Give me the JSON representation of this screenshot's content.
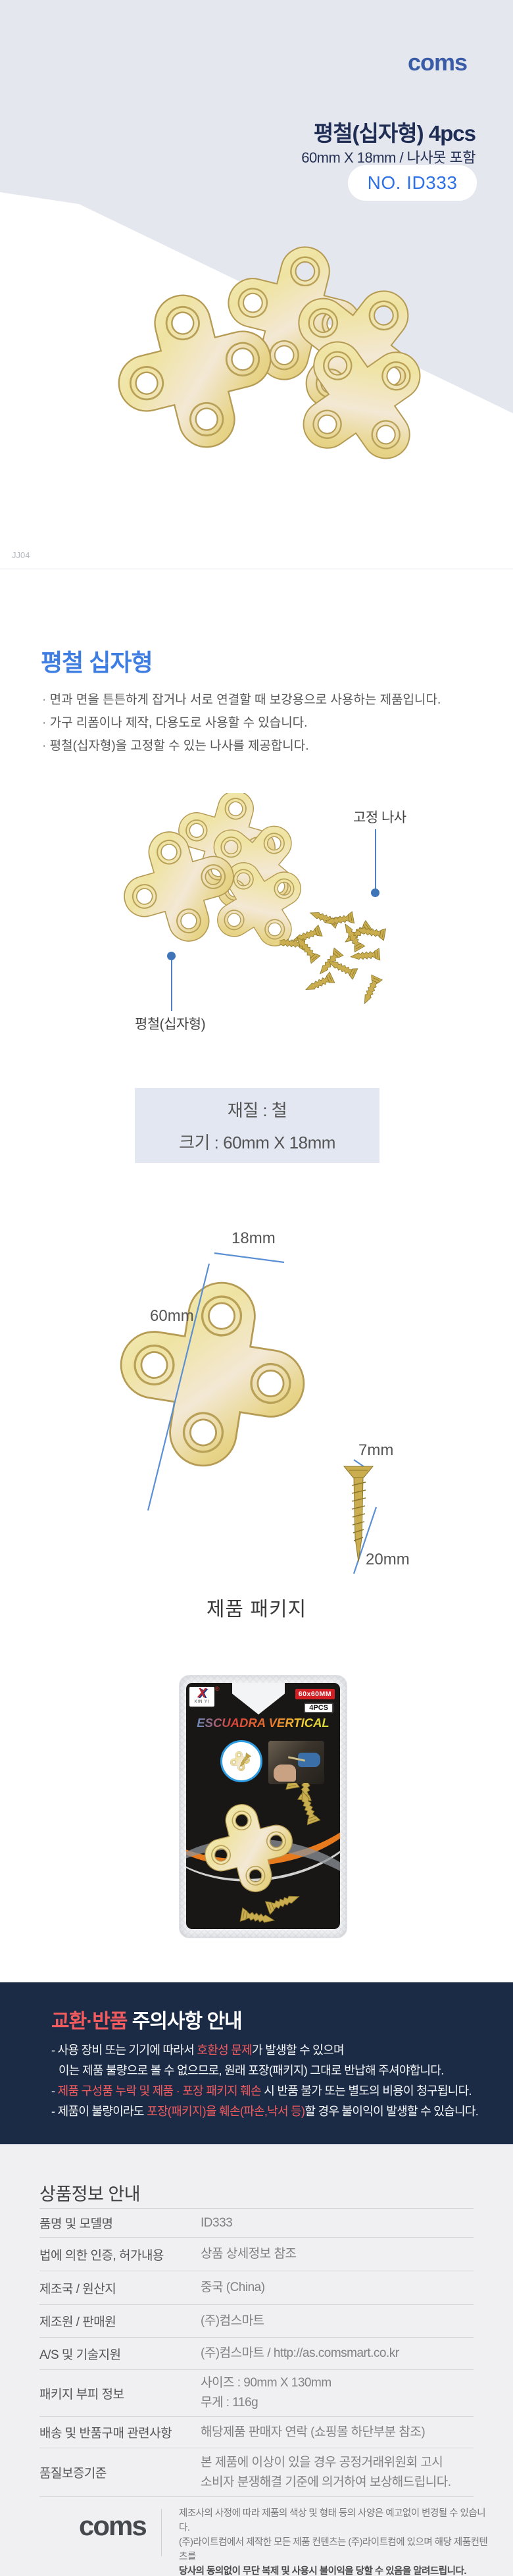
{
  "header": {
    "logo": "coms",
    "title": "평철(십자형) 4pcs",
    "subtitle": "60mm X 18mm / 나사못 포함",
    "badge": "NO. ID333",
    "watermark": "JJ04"
  },
  "intro": {
    "heading": "평철 십자형",
    "bullets": [
      "면과 면을 튼튼하게 잡거나 서로 연결할 때 보강용으로 사용하는 제품입니다.",
      "가구 리폼이나 제작, 다용도로 사용할 수 있습니다.",
      "평철(십자형)을 고정할 수 있는 나사를 제공합니다."
    ]
  },
  "photo_labels": {
    "screw": "고정 나사",
    "plate": "평철(십자형)"
  },
  "spec": {
    "material": "재질 : 철",
    "size": "크기 : 60mm X 18mm"
  },
  "dimensions": {
    "width": "18mm",
    "height": "60mm",
    "screw_head": "7mm",
    "screw_length": "20mm"
  },
  "package": {
    "heading": "제품 패키지",
    "brand_mark": "X",
    "brand_name": "XIN YI",
    "brand_reg": "®",
    "size_badge": "60x60MM",
    "qty_badge": "4PCS",
    "title": "ESCUADRA VERTICAL"
  },
  "notice": {
    "title_red": "교환·반품",
    "title_rest": " 주의사항 안내",
    "l1_pre": "- 사용 장비 또는 기기에 따라서 ",
    "l1_red": "호환성 문제",
    "l1_post": "가 발생할 수 있으며",
    "l2": "이는 제품 불량으로 볼 수 없으므로, 원래 포장(패키지) 그대로 반납해 주셔야합니다.",
    "l3_pre": "- ",
    "l3_red": "제품 구성품 누락 및  제품 · 포장 패키지 훼손",
    "l3_post": " 시 반품 불가 또는 별도의 비용이 청구됩니다.",
    "l4_pre": "- 제품이 불량이라도 ",
    "l4_red": "포장(패키지)을 훼손(파손,낙서 등)",
    "l4_post": "할 경우 불이익이 발생할 수 있습니다."
  },
  "info": {
    "heading": "상품정보 안내",
    "rows": [
      {
        "label": "품명 및 모델명",
        "value": "ID333"
      },
      {
        "label": "법에 의한 인증, 허가내용",
        "value": "상품 상세정보 참조"
      },
      {
        "label": "제조국 / 원산지",
        "value": "중국 (China)"
      },
      {
        "label": "제조원 / 판매원",
        "value": "(주)컴스마트"
      },
      {
        "label": "A/S 및 기술지원",
        "value": "(주)컴스마트 / http://as.comsmart.co.kr"
      },
      {
        "label": "패키지 부피 정보",
        "value": "사이즈 : 90mm X 130mm",
        "value2": "무게 : 116g"
      },
      {
        "label": "배송 및 반품구매 관련사항",
        "value": "해당제품 판매자 연락 (쇼핑몰 하단부분 참조)"
      },
      {
        "label": "품질보증기준",
        "value": "본 제품에 이상이 있을 경우 공정거래위원회 고시",
        "value2": "소비자 분쟁해결 기준에 의거하여 보상해드립니다."
      }
    ]
  },
  "footer": {
    "logo": "coms",
    "line1": "제조사의 사정에 따라 제품의 색상 및 형태 등의 사양은 예고없이 변경될 수 있습니다.",
    "line2": "(주)라이트컴에서 제작한 모든 제품 컨텐츠는 (주)라이트컴에 있으며 해당 제품컨텐츠를",
    "line3": "당사의 동의없이 무단 복제 및 사용시 불이익을 당할 수 있음을 알려드립니다.",
    "copyright": "Copyright ⓒ Lightcom All rights Reserved"
  },
  "colors": {
    "brand_blue": "#3a5ba5",
    "badge_blue": "#2e70e8",
    "heading_blue": "#3e7ee2",
    "navy": "#1b2b46",
    "alert_red": "#f15b5e",
    "plate_gold": "#e7d488",
    "annotation_blue": "#4c82c4"
  }
}
